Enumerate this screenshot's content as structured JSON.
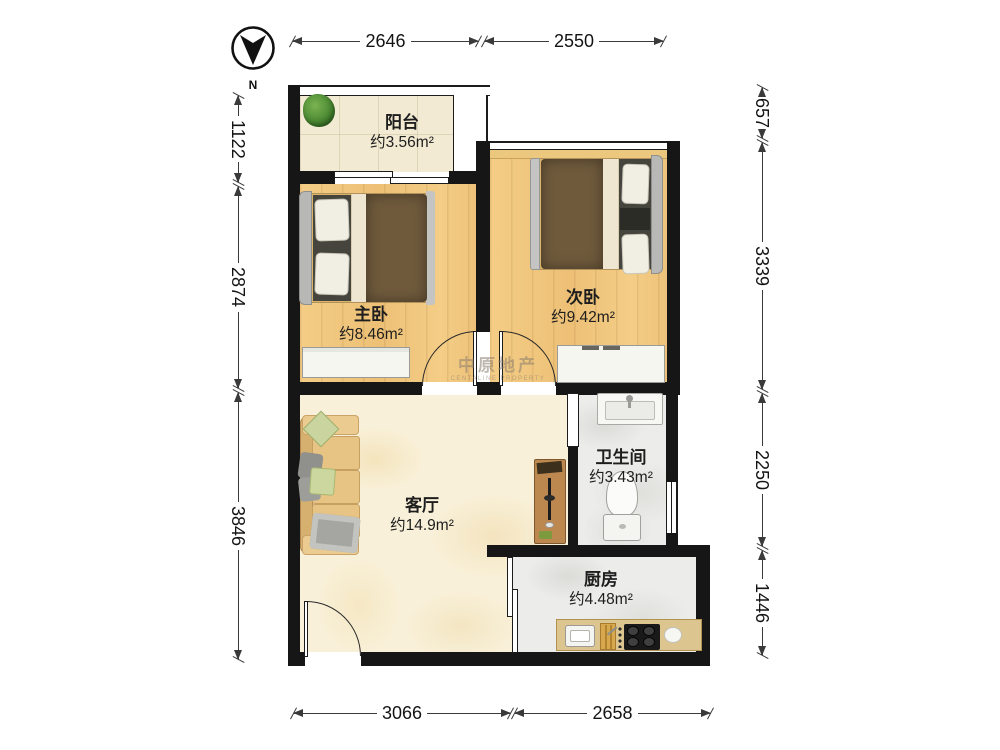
{
  "compass": {
    "label": "N"
  },
  "watermark": {
    "line1": "中原地产",
    "line2": "CENTALINE PROPERTY"
  },
  "rooms": {
    "balcony": {
      "name": "阳台",
      "area": "约3.56m²"
    },
    "master_bedroom": {
      "name": "主卧",
      "area": "约8.46m²"
    },
    "second_bedroom": {
      "name": "次卧",
      "area": "约9.42m²"
    },
    "living_room": {
      "name": "客厅",
      "area": "约14.9m²"
    },
    "bathroom": {
      "name": "卫生间",
      "area": "约3.43m²"
    },
    "kitchen": {
      "name": "厨房",
      "area": "约4.48m²"
    }
  },
  "dimensions": {
    "top": [
      "2646",
      "2550"
    ],
    "bottom": [
      "3066",
      "2658"
    ],
    "left": [
      "1122",
      "2874",
      "3846"
    ],
    "right": [
      "657",
      "3339",
      "2250",
      "1446"
    ]
  },
  "colors": {
    "wall": "#161616",
    "wood_floor": "#f2c87e",
    "balcony_tile": "#f2ead2",
    "marble_floor": "#f8f0d8",
    "wet_room_floor": "#ececea",
    "counter": "#dcc58f",
    "bed_blanket": "#6f5a3c",
    "sofa": "#e7c384"
  }
}
